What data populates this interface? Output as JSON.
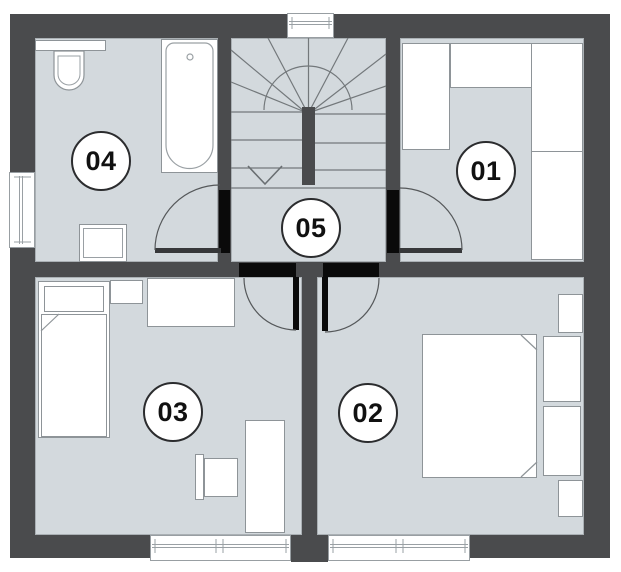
{
  "plan": {
    "rooms": [
      {
        "id": "room-01",
        "label": "01"
      },
      {
        "id": "room-02",
        "label": "02"
      },
      {
        "id": "room-03",
        "label": "03"
      },
      {
        "id": "room-04",
        "label": "04"
      },
      {
        "id": "room-05",
        "label": "05"
      }
    ],
    "colors": {
      "wall": "#4a4b4d",
      "floor": "#d3d9dd",
      "fixture_fill": "#ffffff",
      "doorway_black": "#0a0a0a",
      "detail_line": "#73787b"
    },
    "fixtures": {
      "room_04": [
        "toilet",
        "bathtub",
        "washing-machine",
        "window",
        "door"
      ],
      "stairwell": [
        "winder-staircase",
        "stair-newel",
        "down-arrow",
        "window"
      ],
      "room_01": [
        "wardrobe-left",
        "wardrobe-top",
        "wardrobe-right",
        "door"
      ],
      "room_05": [
        "landing"
      ],
      "room_03": [
        "single-bed",
        "pillow",
        "duvet",
        "shelf",
        "desk",
        "chair",
        "side-table",
        "window",
        "door"
      ],
      "room_02": [
        "double-bed",
        "pillow",
        "pillow",
        "nightstand",
        "nightstand",
        "window",
        "door"
      ]
    }
  }
}
